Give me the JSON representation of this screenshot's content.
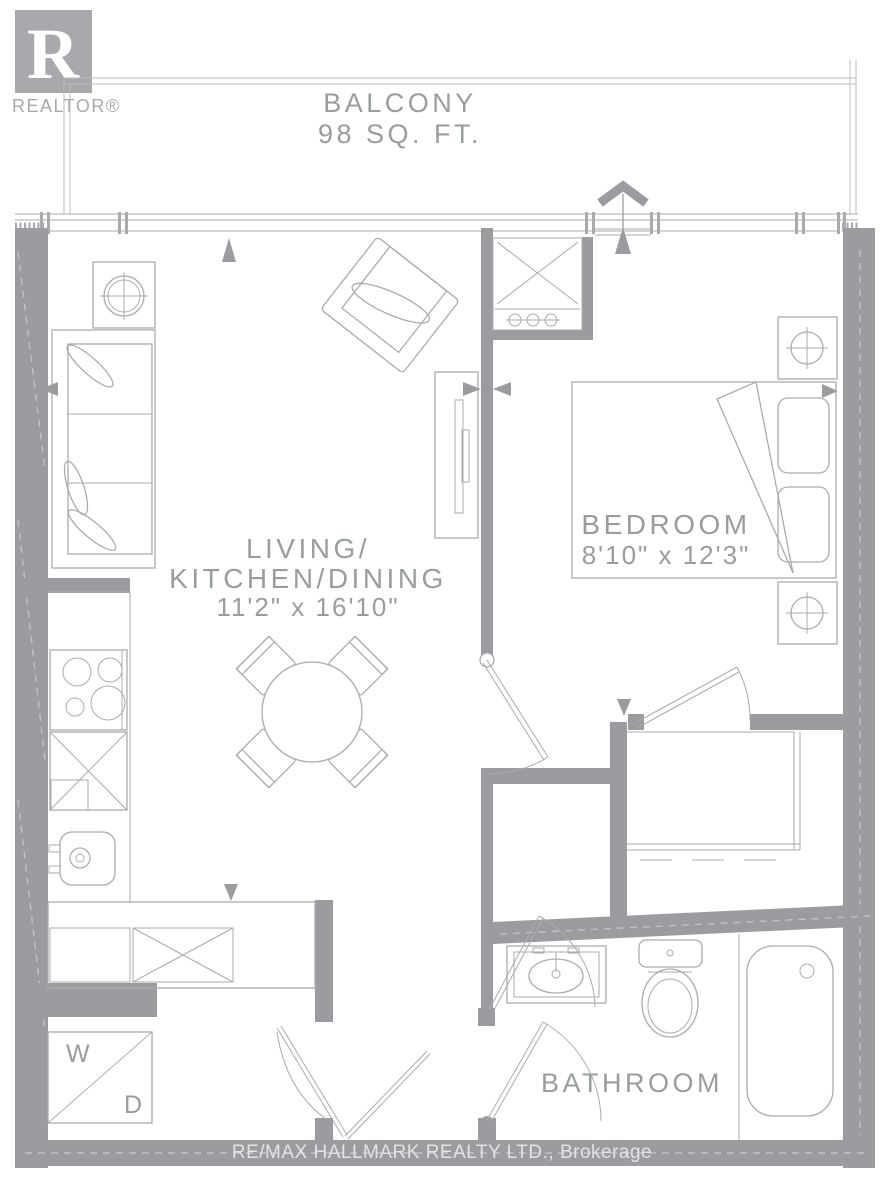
{
  "colors": {
    "wall": "#9c9ca0",
    "furniture_line": "#a9acae",
    "text": "#989da0",
    "logo": "#a9a9ad",
    "footer_text": "#e3e3e6"
  },
  "logo": {
    "letter": "R",
    "brand": "REALTOR®"
  },
  "rooms": {
    "balcony": {
      "name": "BALCONY",
      "area": "98 SQ. FT."
    },
    "living": {
      "line1": "LIVING/",
      "line2": "KITCHEN/DINING",
      "dims": "11'2\" x 16'10\""
    },
    "bedroom": {
      "name": "BEDROOM",
      "dims": "8'10\" x 12'3\""
    },
    "bathroom": {
      "name": "BATHROOM"
    }
  },
  "laundry": {
    "washer": "W",
    "dryer": "D"
  },
  "footer": {
    "brokerage": "RE/MAX HALLMARK REALTY LTD., Brokerage"
  },
  "fixtures": [
    "sofa",
    "armchair",
    "side-table",
    "tv-console",
    "dining-table",
    "dining-chair",
    "cooktop",
    "cabinet",
    "kitchen-sink",
    "washer-dryer",
    "bed",
    "pillow",
    "nightstand",
    "closet",
    "vanity-sink",
    "toilet",
    "bathtub",
    "hvac-closet"
  ]
}
